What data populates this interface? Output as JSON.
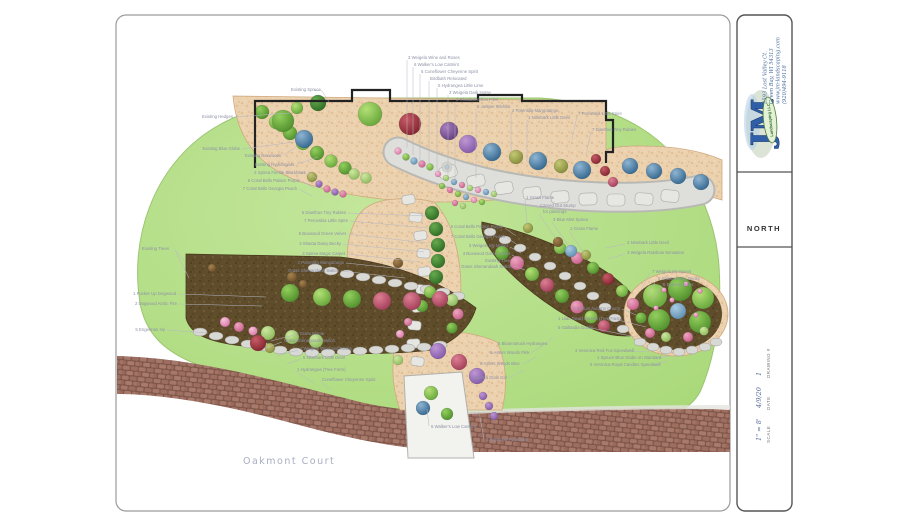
{
  "title_block": {
    "company": {
      "initials": "JM",
      "name": "Landscaping LLC",
      "address_lines": [
        "2593 Lost Valley Ct.",
        "Green Bay, WI 54313",
        "www.jm-landscaping.com",
        "(920)494-9118"
      ]
    },
    "north_label": "NORTH",
    "fields": [
      {
        "label": "SCALE",
        "value": "1\" = 8'"
      },
      {
        "label": "DATE",
        "value": "4/9/20"
      },
      {
        "label": "DRAWING #",
        "value": "1"
      }
    ]
  },
  "palette": {
    "logo_blue": "#2f5fa8",
    "lawn_green": "#b7e08c",
    "bed_tan": "#ecd1ae",
    "mulch_brown": "#5e4c2b",
    "street_brick": "#936555"
  },
  "plan": {
    "street_name": "Oakmont Court",
    "labels": [
      {
        "t": "3 Weigela Wine and Roses",
        "x": 408,
        "y": 59,
        "lines": [
          [
            407,
            60,
            407,
            148
          ]
        ]
      },
      {
        "t": "6 Walker's Low Catmint",
        "x": 414,
        "y": 66,
        "lines": [
          [
            413,
            67,
            413,
            155
          ]
        ]
      },
      {
        "t": "5 Coneflower Cheyenne Spirit",
        "x": 421,
        "y": 73,
        "lines": [
          [
            420,
            74,
            420,
            161
          ]
        ]
      },
      {
        "t": "Birdbath Relocated",
        "x": 430,
        "y": 80,
        "lines": [
          [
            429,
            81,
            429,
            164
          ]
        ]
      },
      {
        "t": "5 Hydrangea Little Lime",
        "x": 438,
        "y": 87,
        "lines": [
          [
            437,
            88,
            437,
            170
          ]
        ]
      },
      {
        "t": "3 Weigela Dark Horse",
        "x": 449,
        "y": 94,
        "lines": [
          [
            448,
            95,
            448,
            176
          ]
        ]
      },
      {
        "t": "3 Rhododendron PJM",
        "x": 456,
        "y": 101,
        "lines": [
          [
            455,
            102,
            455,
            181
          ]
        ]
      },
      {
        "t": "2 Juniper Wichita",
        "x": 477,
        "y": 108,
        "lines": [
          [
            476,
            109,
            476,
            178
          ]
        ]
      },
      {
        "t": "2 Potentilla Mangotango",
        "x": 512,
        "y": 112,
        "lines": [
          [
            511,
            113,
            511,
            152
          ]
        ]
      },
      {
        "t": "1 Ninebark Little Devil",
        "x": 528,
        "y": 119,
        "lines": [
          [
            527,
            120,
            527,
            162
          ]
        ]
      },
      {
        "t": "7 Perovskia Little Spire",
        "x": 578,
        "y": 115,
        "lines": [
          [
            577,
            116,
            572,
            140
          ]
        ]
      },
      {
        "t": "7 Dianthus Tiny Rubies",
        "x": 592,
        "y": 131,
        "lines": [
          [
            591,
            132,
            586,
            155
          ]
        ]
      },
      {
        "t": "Existing Spruce",
        "x": 291,
        "y": 91,
        "lines": [
          [
            314,
            90,
            322,
            91,
            329,
            102
          ]
        ]
      },
      {
        "t": "Existing Hedges",
        "a": "e",
        "x": 233,
        "y": 118,
        "lines": [
          [
            235,
            117,
            290,
            113
          ]
        ]
      },
      {
        "t": "Existing Blue Globe",
        "a": "e",
        "x": 240,
        "y": 150,
        "lines": [
          [
            242,
            149,
            294,
            142
          ]
        ]
      },
      {
        "t": "Existing Boxwoods",
        "x": 245,
        "y": 157,
        "lines": [
          [
            284,
            155,
            296,
            147
          ]
        ]
      },
      {
        "t": "Existing Hydrangeas",
        "x": 255,
        "y": 166,
        "lines": [
          [
            297,
            164,
            318,
            157
          ]
        ]
      },
      {
        "t": "2 Spirea Firelite Blackhawk",
        "a": "e",
        "x": 306,
        "y": 174,
        "lines": [
          [
            308,
            173,
            318,
            179
          ]
        ]
      },
      {
        "t": "6 Coral Bells Palace Purple",
        "a": "e",
        "x": 300,
        "y": 182,
        "lines": [
          [
            302,
            181,
            314,
            188
          ]
        ]
      },
      {
        "t": "7 Coral Bells Georgia Peach",
        "a": "e",
        "x": 297,
        "y": 190,
        "lines": [
          [
            299,
            189,
            312,
            196
          ]
        ]
      },
      {
        "t": "5 Dianthus Tiny Rubies",
        "a": "e",
        "x": 346,
        "y": 214,
        "lines": [
          [
            348,
            213,
            426,
            216
          ]
        ]
      },
      {
        "t": "7 Perovskia Little Spire",
        "a": "e",
        "x": 348,
        "y": 222,
        "lines": [
          [
            350,
            221,
            428,
            228
          ]
        ]
      },
      {
        "t": "5 Boxwood Green Velvet",
        "a": "e",
        "x": 346,
        "y": 235,
        "lines": [
          [
            348,
            234,
            427,
            243
          ]
        ]
      },
      {
        "t": "3 Shasta Daisy Becky",
        "a": "e",
        "x": 341,
        "y": 245,
        "lines": [
          [
            343,
            244,
            424,
            252
          ]
        ]
      },
      {
        "t": "3 Spirea Magic Carpet",
        "a": "e",
        "x": 345,
        "y": 255,
        "lines": [
          [
            347,
            254,
            420,
            262
          ]
        ]
      },
      {
        "t": "2 Potentilla Mangotango",
        "a": "e",
        "x": 344,
        "y": 264,
        "lines": [
          [
            346,
            263,
            413,
            270
          ]
        ]
      },
      {
        "t": "Grass Shenandoah Switch",
        "a": "e",
        "x": 339,
        "y": 272,
        "lines": [
          [
            341,
            271,
            405,
            278
          ]
        ]
      },
      {
        "t": "Existing Trees",
        "x": 142,
        "y": 250,
        "lines": [
          [
            175,
            250,
            184,
            260
          ],
          [
            175,
            250,
            189,
            278
          ]
        ]
      },
      {
        "t": "1 Pucker Up Dogwood",
        "a": "e",
        "x": 176,
        "y": 295,
        "lines": [
          [
            178,
            294,
            266,
            297
          ]
        ]
      },
      {
        "t": "2 Dogwood Arctic Fire",
        "a": "e",
        "x": 177,
        "y": 305,
        "lines": [
          [
            179,
            304,
            262,
            306
          ]
        ]
      },
      {
        "t": "5 Engelman Ivy",
        "a": "e",
        "x": 165,
        "y": 331,
        "lines": [
          [
            167,
            330,
            208,
            333
          ]
        ]
      },
      {
        "t": "1 Grass Flame",
        "x": 296,
        "y": 335,
        "lines": [
          [
            294,
            335,
            271,
            341
          ]
        ]
      },
      {
        "t": "Grass Shenandoah Switch",
        "x": 284,
        "y": 342,
        "lines": [
          [
            282,
            342,
            263,
            349
          ]
        ]
      },
      {
        "t": "1 Weigela Wine and Roses",
        "x": 300,
        "y": 350,
        "lines": [
          [
            298,
            350,
            277,
            356
          ]
        ]
      },
      {
        "t": "5 Ninebark Little Devil",
        "x": 303,
        "y": 359,
        "lines": [
          [
            301,
            359,
            287,
            364
          ]
        ]
      },
      {
        "t": "1 Hydrangea (Tree Form)",
        "x": 297,
        "y": 371,
        "lines": [
          [
            295,
            371,
            314,
            383
          ]
        ]
      },
      {
        "t": "Coneflower Cheyenne Spirit",
        "x": 322,
        "y": 381,
        "lines": [
          [
            320,
            381,
            332,
            391
          ]
        ]
      },
      {
        "t": "2 Boxwood Pyramidal",
        "x": 486,
        "y": 441,
        "lines": [
          [
            484,
            439,
            479,
            412
          ]
        ]
      },
      {
        "t": "5 Walker's Low Catmint",
        "x": 431,
        "y": 428,
        "lines": [
          [
            429,
            426,
            427,
            409
          ]
        ]
      },
      {
        "t": "1 Grass Flame",
        "x": 526,
        "y": 199,
        "lines": [
          [
            525,
            200,
            527,
            224
          ]
        ]
      },
      {
        "t": "Carved Out Stump",
        "x": 540,
        "y": 207
      },
      {
        "t": "for plantings",
        "x": 543,
        "y": 213,
        "lines": [
          [
            539,
            214,
            556,
            239
          ]
        ]
      },
      {
        "t": "3 Blue Mist Spirea",
        "x": 553,
        "y": 221,
        "lines": [
          [
            552,
            222,
            570,
            248
          ]
        ]
      },
      {
        "t": "1 Grass Flame",
        "x": 570,
        "y": 230,
        "lines": [
          [
            569,
            231,
            584,
            253
          ]
        ]
      },
      {
        "t": "6 Coral Bells Palace Purple",
        "a": "e",
        "x": 503,
        "y": 228,
        "lines": [
          [
            505,
            228,
            516,
            236
          ]
        ]
      },
      {
        "t": "7 Coral Bells Georgia Peach",
        "a": "e",
        "x": 505,
        "y": 238,
        "lines": [
          [
            507,
            238,
            518,
            245
          ]
        ]
      },
      {
        "t": "3 Weigela My Monet",
        "a": "e",
        "x": 508,
        "y": 247,
        "lines": [
          [
            510,
            247,
            521,
            253
          ]
        ]
      },
      {
        "t": "3 Boxwood Green Velvet",
        "a": "e",
        "x": 510,
        "y": 255,
        "lines": [
          [
            512,
            255,
            523,
            261
          ]
        ]
      },
      {
        "t": "Existing Tree",
        "a": "e",
        "x": 510,
        "y": 262
      },
      {
        "t": "Grass Shenandoah Switch",
        "a": "e",
        "x": 512,
        "y": 268,
        "lines": [
          [
            514,
            266,
            525,
            270
          ]
        ]
      },
      {
        "t": "2 Ninebark Little Devil",
        "x": 627,
        "y": 244,
        "lines": [
          [
            625,
            244,
            606,
            248
          ]
        ]
      },
      {
        "t": "3 Weigela Rainbow Sensation",
        "x": 627,
        "y": 254,
        "lines": [
          [
            625,
            254,
            608,
            259
          ]
        ]
      },
      {
        "t": "7 Weigela My Monet",
        "x": 652,
        "y": 273,
        "lines": [
          [
            650,
            273,
            641,
            290
          ]
        ]
      },
      {
        "t": "5 Shasta Daisy Becky",
        "x": 658,
        "y": 280,
        "lines": [
          [
            656,
            280,
            648,
            296
          ]
        ]
      },
      {
        "t": "6 Existing Trees",
        "x": 663,
        "y": 286,
        "lines": [
          [
            661,
            286,
            652,
            301
          ]
        ]
      },
      {
        "t": "2 Sedum Autumn Charm",
        "x": 573,
        "y": 310,
        "lines": [
          [
            622,
            309,
            636,
            315
          ]
        ]
      },
      {
        "t": "1 Lilac Dwarf Korean (Tree Form)",
        "x": 558,
        "y": 320,
        "lines": [
          [
            614,
            319,
            646,
            327
          ]
        ]
      },
      {
        "t": "5 Gaillardia Goblin",
        "x": 558,
        "y": 329,
        "lines": [
          [
            591,
            328,
            636,
            337
          ]
        ]
      },
      {
        "t": "4 Veronica Red Fox Speedwell",
        "x": 575,
        "y": 352,
        "lines": [
          [
            629,
            351,
            650,
            352
          ]
        ]
      },
      {
        "t": "1 Spruce Blue Globe on Standard",
        "x": 597,
        "y": 359,
        "lines": [
          [
            656,
            358,
            670,
            356
          ]
        ]
      },
      {
        "t": "5 Veronica Royal Candles Speedwell",
        "x": 590,
        "y": 366,
        "lines": [
          [
            654,
            365,
            668,
            361
          ]
        ]
      },
      {
        "t": "5 Bloomstruck Hydrangea",
        "x": 498,
        "y": 345,
        "lines": [
          [
            545,
            344,
            553,
            337
          ]
        ]
      },
      {
        "t": "6 Asters Woods Pink",
        "x": 490,
        "y": 354,
        "lines": [
          [
            531,
            353,
            542,
            346
          ]
        ]
      },
      {
        "t": "5 Asters Woods Blue",
        "x": 480,
        "y": 365,
        "lines": [
          [
            523,
            364,
            536,
            357
          ]
        ]
      },
      {
        "t": "3 Spirea Glow Girl",
        "x": 472,
        "y": 379,
        "lines": [
          [
            509,
            378,
            524,
            370
          ]
        ]
      }
    ]
  }
}
